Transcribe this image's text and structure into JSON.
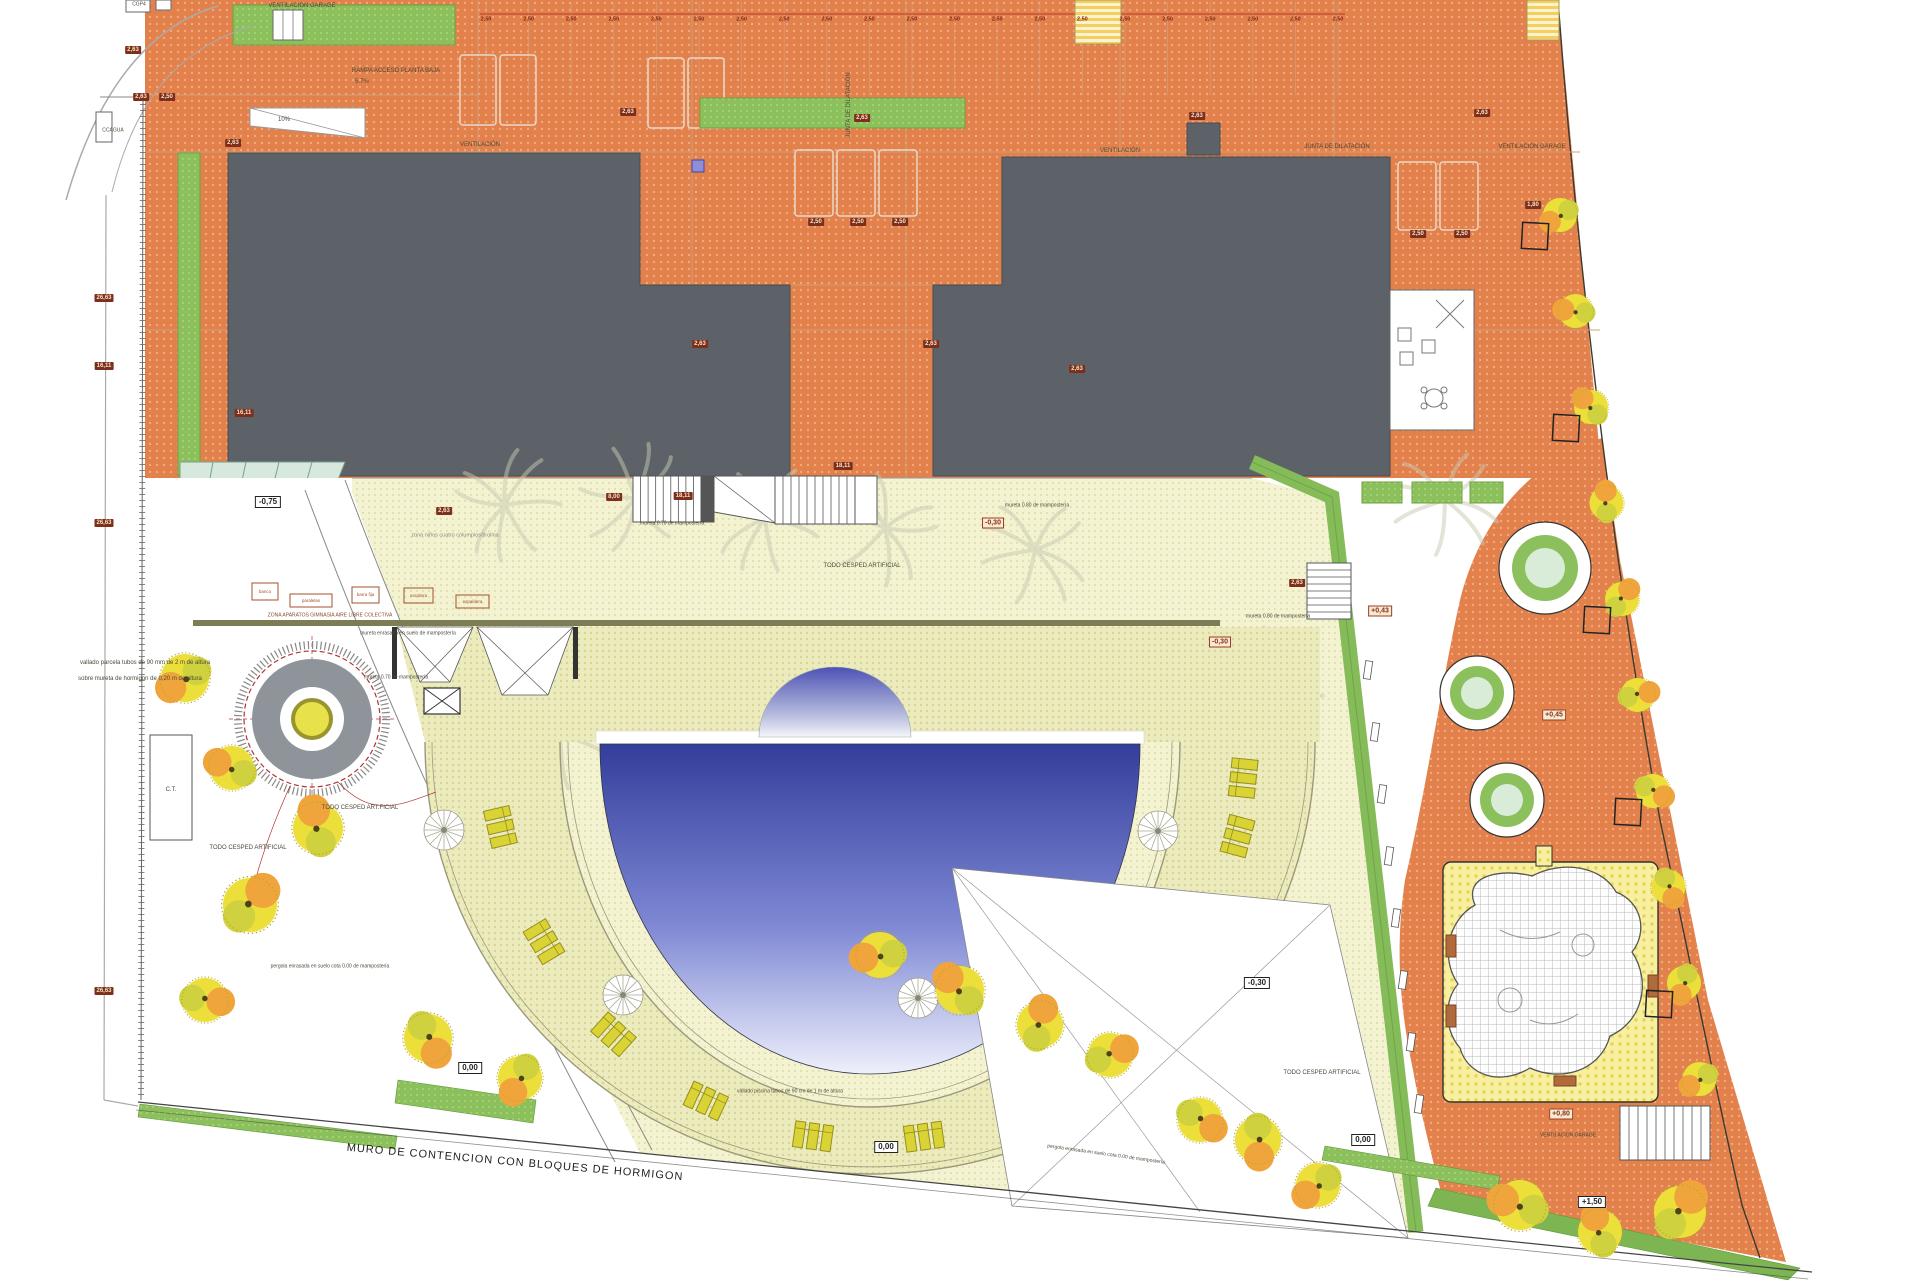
{
  "plan": {
    "labels": [
      {
        "t": "VENTILACION GARAGE",
        "x": 302,
        "y": 6,
        "s": 6
      },
      {
        "t": "RAMPA ACCESO PLANTA BAJA",
        "x": 396,
        "y": 71,
        "s": 6
      },
      {
        "t": "5.7%",
        "x": 362,
        "y": 82,
        "s": 6
      },
      {
        "t": "10%",
        "x": 284,
        "y": 120,
        "s": 6
      },
      {
        "t": "VENTILACIÓN",
        "x": 480,
        "y": 145,
        "s": 6
      },
      {
        "t": "VENTILACIÓN",
        "x": 1120,
        "y": 151,
        "s": 6
      },
      {
        "t": "JUNTA DE DILATACIÓN",
        "x": 1337,
        "y": 147,
        "s": 6
      },
      {
        "t": "VENTILACION GARAGE",
        "x": 1532,
        "y": 147,
        "s": 6
      },
      {
        "t": "JUNTA DE DILATACIÓN",
        "x": 849,
        "y": 105,
        "s": 6,
        "r": -90
      },
      {
        "t": "zona niños cuatro columpios/tirolina",
        "x": 455,
        "y": 536,
        "s": 5.5,
        "c": "#8a8a7a"
      },
      {
        "t": "TODO CESPED ARTIFICIAL",
        "x": 862,
        "y": 566,
        "s": 6
      },
      {
        "t": "ZONA APARATOS GIMNASIA AIRE LIBRE COLECTIVA",
        "x": 330,
        "y": 616,
        "s": 5,
        "c": "#8a4a28"
      },
      {
        "t": "mureta enrasada en suelo de mampostería",
        "x": 408,
        "y": 634,
        "s": 5
      },
      {
        "t": "mureta 0.70 de mampostería",
        "x": 672,
        "y": 524,
        "s": 5
      },
      {
        "t": "mureta 0.70 de mampostería",
        "x": 396,
        "y": 678,
        "s": 5
      },
      {
        "t": "mureta 0.80 de mampostería",
        "x": 1037,
        "y": 506,
        "s": 5
      },
      {
        "t": "mureta 0.80 de mampostería",
        "x": 1278,
        "y": 617,
        "s": 5
      },
      {
        "t": "TODO CESPED ART.FICIAL",
        "x": 360,
        "y": 808,
        "s": 6
      },
      {
        "t": "TODO CESPED ARTIFICIAL",
        "x": 248,
        "y": 848,
        "s": 6
      },
      {
        "t": "TODO CESPED ARTIFICIAL",
        "x": 1322,
        "y": 1073,
        "s": 6
      },
      {
        "t": "vallado parcela tubos de 90 mm de 2 m de altura",
        "x": 145,
        "y": 663,
        "s": 6
      },
      {
        "t": "sobre mureta de hormigon de 0,20 m de altura",
        "x": 140,
        "y": 679,
        "s": 6
      },
      {
        "t": "vallado piscina tubos de 90 cm de 1 m de altura",
        "x": 790,
        "y": 1092,
        "s": 5
      },
      {
        "t": "pergola enrasada en suelo cota 0.00 de mampostería",
        "x": 330,
        "y": 967,
        "s": 5
      },
      {
        "t": "pergola enrasada en suelo cota 0.00 de mampostería",
        "x": 1106,
        "y": 1155,
        "s": 5,
        "r": 8
      },
      {
        "t": "MURO DE CONTENCION  CON BLOQUES DE HORMIGON",
        "x": 515,
        "y": 1163,
        "s": 11,
        "r": 5,
        "c": "#222",
        "ls": 1
      },
      {
        "t": "C.T.",
        "x": 171,
        "y": 790,
        "s": 6
      },
      {
        "t": "CCAGUA",
        "x": 113,
        "y": 131,
        "s": 5
      },
      {
        "t": "CGP4",
        "x": 139,
        "y": 5,
        "s": 5
      },
      {
        "t": "VENTILACION GARAGE",
        "x": 1568,
        "y": 1136,
        "s": 5
      }
    ],
    "dims": [
      {
        "t": "2,63",
        "x": 133,
        "y": 50
      },
      {
        "t": "2,63",
        "x": 141,
        "y": 97
      },
      {
        "t": "2,50",
        "x": 167,
        "y": 97
      },
      {
        "t": "26,63",
        "x": 104,
        "y": 298
      },
      {
        "t": "16,11",
        "x": 104,
        "y": 366
      },
      {
        "t": "26,63",
        "x": 104,
        "y": 523
      },
      {
        "t": "26,63",
        "x": 104,
        "y": 991
      },
      {
        "t": "2,63",
        "x": 233,
        "y": 143
      },
      {
        "t": "16,11",
        "x": 244,
        "y": 413
      },
      {
        "t": "2,63",
        "x": 628,
        "y": 112
      },
      {
        "t": "2,63",
        "x": 862,
        "y": 118
      },
      {
        "t": "2,63",
        "x": 1197,
        "y": 116
      },
      {
        "t": "2,63",
        "x": 1482,
        "y": 113
      },
      {
        "t": "1,80",
        "x": 1533,
        "y": 205
      },
      {
        "t": "2,63",
        "x": 700,
        "y": 344
      },
      {
        "t": "2,63",
        "x": 931,
        "y": 344
      },
      {
        "t": "2,63",
        "x": 1077,
        "y": 369
      },
      {
        "t": "8,00",
        "x": 614,
        "y": 497
      },
      {
        "t": "18,11",
        "x": 683,
        "y": 496
      },
      {
        "t": "18,11",
        "x": 843,
        "y": 466
      },
      {
        "t": "2,63",
        "x": 1297,
        "y": 583
      },
      {
        "t": "2,63",
        "x": 444,
        "y": 511
      },
      {
        "t": "2,50",
        "x": 816,
        "y": 222
      },
      {
        "t": "2,50",
        "x": 858,
        "y": 222
      },
      {
        "t": "2,50",
        "x": 900,
        "y": 222
      },
      {
        "t": "2,50",
        "x": 1418,
        "y": 234
      },
      {
        "t": "2,50",
        "x": 1462,
        "y": 234
      }
    ],
    "levels": [
      {
        "t": "-0,75",
        "x": 268,
        "y": 502,
        "k": "lvl"
      },
      {
        "t": "-0,30",
        "x": 993,
        "y": 523,
        "k": "lvlr"
      },
      {
        "t": "-0,30",
        "x": 1220,
        "y": 642,
        "k": "lvlr"
      },
      {
        "t": "+0,43",
        "x": 1380,
        "y": 611,
        "k": "lvlr"
      },
      {
        "t": "+0,45",
        "x": 1554,
        "y": 715,
        "k": "lvlr"
      },
      {
        "t": "-0,30",
        "x": 1257,
        "y": 983,
        "k": "lvl"
      },
      {
        "t": "0,00",
        "x": 470,
        "y": 1068,
        "k": "lvl"
      },
      {
        "t": "0,00",
        "x": 886,
        "y": 1147,
        "k": "lvl"
      },
      {
        "t": "0,00",
        "x": 1363,
        "y": 1140,
        "k": "lvl"
      },
      {
        "t": "+0,80",
        "x": 1561,
        "y": 1114,
        "k": "lvlr"
      },
      {
        "t": "+1,50",
        "x": 1592,
        "y": 1202,
        "k": "lvl"
      }
    ],
    "dim_row": {
      "value": "2,50",
      "count": 21,
      "x0": 486,
      "step": 42.6,
      "y": 20
    },
    "gym_zone": {
      "boxes": [
        "banco",
        "paralelas",
        "barra fija",
        "escalera",
        "espaldera"
      ]
    },
    "colors": {
      "paving": "#e2814c",
      "building": "#5c6268",
      "grass_artificial": "#f3f3d2",
      "deck": "#ecebbe",
      "hedge": "#8cc05c",
      "pool_dark": "#333e9b",
      "pool_light": "#eef0fb",
      "lounger": "#d9d335",
      "tree_yellow": "#ecdf3a",
      "tree_orange": "#f0a43c",
      "play_area": "#f8f0a0",
      "teal": "#d6e9dc"
    }
  }
}
